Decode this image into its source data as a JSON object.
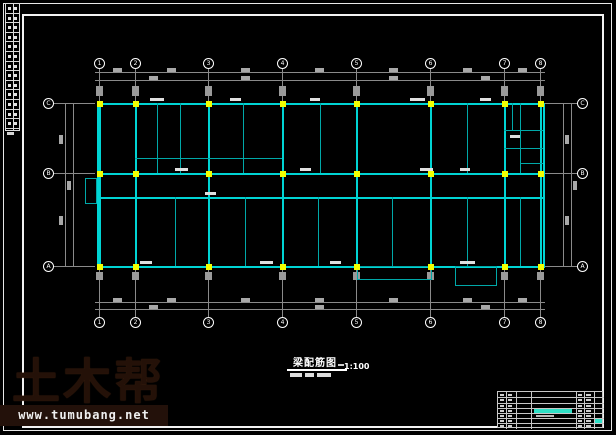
{
  "watermark": {
    "brand": "土木帮",
    "url": "www.tumubang.net"
  },
  "drawing_title": {
    "text": "梁配筋图",
    "scale": "1:100"
  },
  "axes": {
    "top": [
      "1",
      "2",
      "3",
      "4",
      "5",
      "6",
      "7",
      "8"
    ],
    "bottom": [
      "1",
      "2",
      "3",
      "4",
      "5",
      "6",
      "7",
      "8"
    ],
    "left": [
      "C",
      "B",
      "A"
    ],
    "right": [
      "C",
      "B",
      "A"
    ]
  },
  "colors": {
    "background": "#000000",
    "beam": "#00d4d4",
    "beam_minor": "#00a8a8",
    "column": "#f2ff00",
    "annotation": "#f2ff00",
    "dimension": "#8a8a8a",
    "dim_text": "#a8a8a8",
    "frame": "#f2f2f2",
    "label": "#e0e0e0",
    "titleblock_accent": "#2fe0c6",
    "watermark_brown": "#23110a"
  },
  "plan": {
    "axes_x": [
      99,
      135,
      208,
      282,
      356,
      430,
      504,
      540
    ],
    "rows_y": [
      103,
      173,
      197,
      266
    ],
    "wall_left": 97,
    "wall_right": 543,
    "upper_vlines": [
      157,
      180,
      243,
      320,
      467,
      520
    ],
    "lower_vlines": [
      175,
      245,
      318,
      392,
      467,
      520
    ],
    "partial_hlines": [
      [
        135,
        158,
        282
      ],
      [
        504,
        130,
        543
      ],
      [
        504,
        148,
        543
      ],
      [
        520,
        163,
        543
      ]
    ],
    "small_vlines": [
      [
        512,
        103,
        130
      ],
      [
        520,
        103,
        148
      ]
    ],
    "protrusions": [
      [
        357,
        266,
        75,
        14
      ],
      [
        455,
        266,
        42,
        20
      ],
      [
        85,
        178,
        12,
        26
      ]
    ],
    "clusters": [
      [
        145,
        115,
        13,
        28
      ],
      [
        167,
        110,
        16,
        36
      ],
      [
        163,
        143,
        20,
        11
      ],
      [
        222,
        122,
        12,
        30
      ],
      [
        293,
        86,
        28,
        16
      ],
      [
        438,
        118,
        11,
        32
      ],
      [
        460,
        110,
        14,
        20
      ],
      [
        481,
        124,
        17,
        13
      ],
      [
        530,
        150,
        13,
        13
      ],
      [
        85,
        181,
        11,
        23
      ],
      [
        120,
        215,
        11,
        26
      ],
      [
        167,
        228,
        7,
        10
      ],
      [
        193,
        213,
        12,
        28
      ],
      [
        230,
        217,
        12,
        25
      ],
      [
        257,
        215,
        11,
        27
      ],
      [
        250,
        182,
        27,
        11
      ],
      [
        303,
        213,
        13,
        25
      ],
      [
        347,
        180,
        6,
        10
      ],
      [
        385,
        230,
        8,
        12
      ],
      [
        455,
        230,
        6,
        10
      ],
      [
        485,
        207,
        13,
        23
      ],
      [
        530,
        180,
        9,
        10
      ],
      [
        373,
        270,
        10,
        8
      ]
    ],
    "beam_labels": [
      [
        150,
        98,
        14
      ],
      [
        230,
        98,
        11
      ],
      [
        310,
        98,
        10
      ],
      [
        410,
        98,
        15
      ],
      [
        480,
        98,
        11
      ],
      [
        175,
        168,
        13
      ],
      [
        300,
        168,
        11
      ],
      [
        420,
        168,
        13
      ],
      [
        460,
        168,
        10
      ],
      [
        205,
        192,
        11
      ],
      [
        140,
        261,
        12
      ],
      [
        260,
        261,
        13
      ],
      [
        330,
        261,
        11
      ],
      [
        460,
        261,
        15
      ],
      [
        510,
        135,
        10
      ]
    ],
    "dim": {
      "top_lines": [
        72,
        80
      ],
      "bottom_lines": [
        302,
        309
      ],
      "left_lines": [
        65,
        73
      ],
      "right_lines": [
        563,
        571
      ],
      "top_blobs1": [
        117,
        171,
        245,
        319,
        393,
        467,
        522
      ],
      "top_blobs2": [
        153,
        245,
        393,
        485
      ],
      "bottom_blobs1": [
        117,
        171,
        245,
        319,
        393,
        467,
        522
      ],
      "bottom_blobs2": [
        153,
        319,
        485
      ],
      "side_blob_ys1": [
        139,
        220
      ],
      "side_blob_ys2": [
        185
      ]
    },
    "bubbles": {
      "top_y": 63,
      "bottom_y": 322,
      "left_x": 48,
      "right_x": 582,
      "side_ys": [
        103,
        173,
        266
      ]
    }
  }
}
